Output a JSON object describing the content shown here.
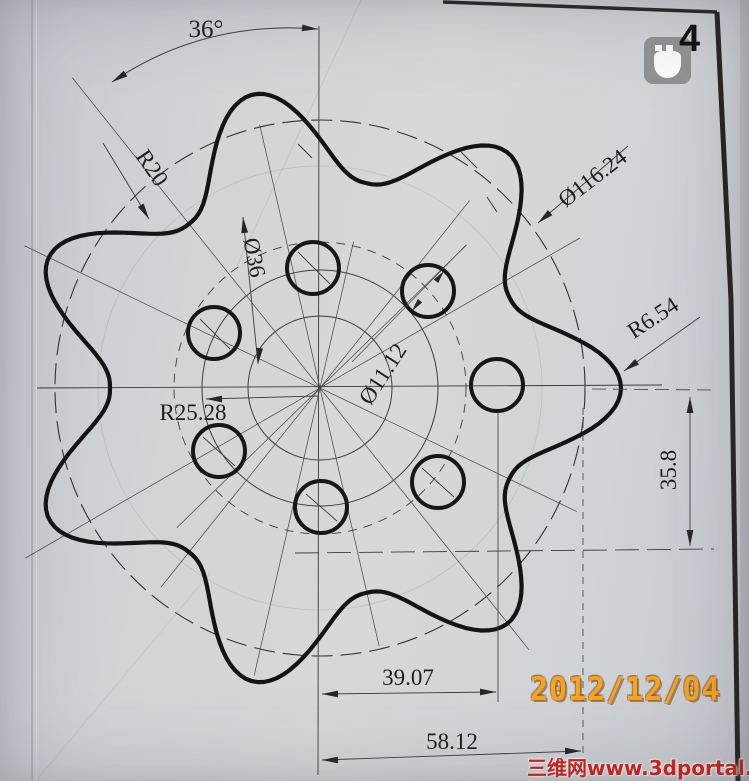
{
  "drawing": {
    "dims": {
      "angle": "36°",
      "root_radius": "R20",
      "pitch_diameter": "Ø116.24",
      "inner_diameter": "Ø36",
      "hole_diameter": "Ø11.12",
      "tip_radius": "R6.54",
      "ref_radius": "R25.28",
      "vertical_offset": "35.8",
      "hole_offset": "39.07",
      "pitch_radius": "58.12"
    }
  },
  "overlay": {
    "page_number": "4",
    "date_stamp": "2012/12/04",
    "watermark": "三维网www.3dportal.cn"
  }
}
